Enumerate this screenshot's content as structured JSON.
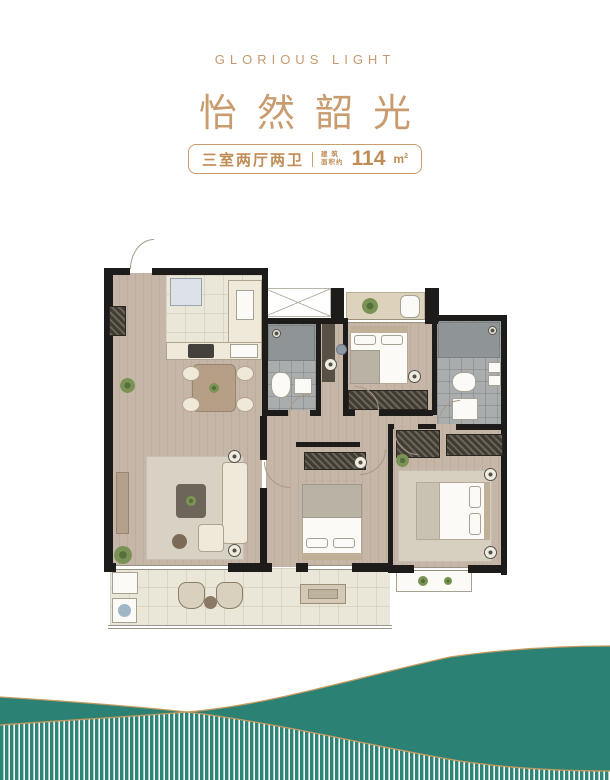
{
  "header": {
    "subtitle_en": "GLORIOUS LIGHT",
    "title_cn": "怡然韶光",
    "badge": {
      "layout": "三室两厅两卫",
      "area_label_line1": "建 筑",
      "area_label_line2": "面积约",
      "area_value": "114",
      "area_unit": "m",
      "area_unit_sup": "2"
    }
  },
  "colors": {
    "gold": "#c49a6e",
    "gold_dark": "#bf8c55",
    "teal": "#2a8174",
    "wall_black": "#1e1c1a",
    "wood_floor": "#c6b6a8",
    "cream_tile": "#eae6d8",
    "gray_tile": "#a9adae"
  }
}
